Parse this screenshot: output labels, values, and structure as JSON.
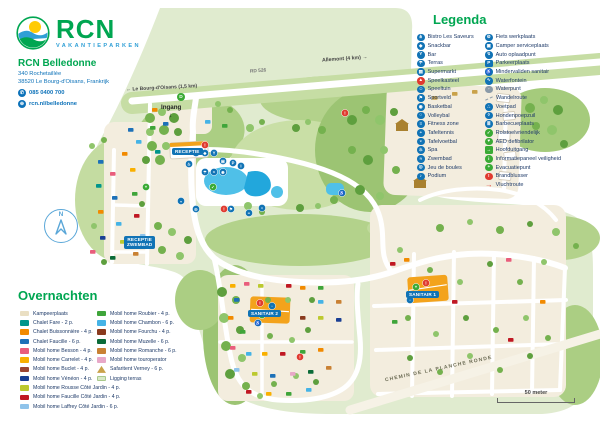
{
  "brand": {
    "logo": "RCN",
    "tagline": "VAKANTIEPARKEN"
  },
  "park": {
    "name": "RCN Belledonne",
    "address1": "340 Rochetaillée",
    "address2": "38520 Le Bourg-d'Oisans, Frankrijk",
    "phone": "085 0400 700",
    "website": "rcn.nl/belledonne"
  },
  "legend": {
    "title": "Legenda",
    "columns": [
      [
        {
          "label": "Bistro Les Saveurs",
          "icon": "restaurant-icon",
          "glyph": "⋔",
          "color": "#1173b5"
        },
        {
          "label": "Snackbar",
          "icon": "snackbar-icon",
          "glyph": "◆",
          "color": "#1173b5"
        },
        {
          "label": "Bar",
          "icon": "bar-icon",
          "glyph": "Y",
          "color": "#1173b5"
        },
        {
          "label": "Terras",
          "icon": "terrace-icon",
          "glyph": "☂",
          "color": "#1173b5"
        },
        {
          "label": "Supermarkt",
          "icon": "supermarket-icon",
          "glyph": "▤",
          "color": "#1173b5"
        },
        {
          "label": "Speelkasteel",
          "icon": "play-castle-icon",
          "glyph": "▲",
          "color": "#e03a2f"
        },
        {
          "label": "Speeltuin",
          "icon": "playground-icon",
          "glyph": "☺",
          "color": "#1173b5"
        },
        {
          "label": "Sportveld",
          "icon": "sports-field-icon",
          "glyph": "⚑",
          "color": "#1173b5"
        },
        {
          "label": "Basketbal",
          "icon": "basketball-icon",
          "glyph": "◉",
          "color": "#1173b5"
        },
        {
          "label": "Volleybal",
          "icon": "volleyball-icon",
          "glyph": "○",
          "color": "#1173b5"
        },
        {
          "label": "Fitness zone",
          "icon": "fitness-icon",
          "glyph": "≡",
          "color": "#1173b5"
        },
        {
          "label": "Tafeltennis",
          "icon": "table-tennis-icon",
          "glyph": "◓",
          "color": "#1173b5"
        },
        {
          "label": "Tafelvoetbal",
          "icon": "table-football-icon",
          "glyph": "◒",
          "color": "#1173b5"
        },
        {
          "label": "Spa",
          "icon": "spa-icon",
          "glyph": "♨",
          "color": "#1173b5"
        },
        {
          "label": "Zwembad",
          "icon": "swimming-pool-icon",
          "glyph": "≈",
          "color": "#1173b5"
        },
        {
          "label": "Jeu de boules",
          "icon": "petanque-icon",
          "glyph": "◎",
          "color": "#1173b5"
        },
        {
          "label": "Podium",
          "icon": "stage-icon",
          "glyph": "♪",
          "color": "#1173b5"
        }
      ],
      [
        {
          "label": "Fiets werkplaats",
          "icon": "bike-repair-icon",
          "glyph": "⚙",
          "color": "#1173b5"
        },
        {
          "label": "Camper serviceplaats",
          "icon": "camper-service-icon",
          "glyph": "▣",
          "color": "#1173b5"
        },
        {
          "label": "Auto oplaadpunt",
          "icon": "ev-charging-icon",
          "glyph": "↯",
          "color": "#1173b5"
        },
        {
          "label": "Parkeerplaats",
          "icon": "parking-icon",
          "glyph": "P",
          "color": "#1173b5",
          "shape": "square"
        },
        {
          "label": "Mindervaliden sanitair",
          "icon": "accessible-sanitary-icon",
          "glyph": "♿",
          "color": "#1173b5"
        },
        {
          "label": "Waterfontein",
          "icon": "water-fountain-icon",
          "glyph": "∿",
          "color": "#1173b5"
        },
        {
          "label": "Waterpunt",
          "icon": "water-point-icon",
          "glyph": "◦",
          "color": "#8a9aa8"
        },
        {
          "label": "Wandelroute",
          "icon": "walking-route-icon",
          "glyph": "",
          "color": "#8a9aa8",
          "shape": "dash"
        },
        {
          "label": "Voetpad",
          "icon": "footpath-icon",
          "glyph": "∴",
          "color": "#1173b5"
        },
        {
          "label": "Hondenpoepzuil",
          "icon": "dog-waste-icon",
          "glyph": "◊",
          "color": "#1173b5"
        },
        {
          "label": "Barbecueplaats",
          "icon": "barbecue-icon",
          "glyph": "≣",
          "color": "#1173b5"
        },
        {
          "label": "Rolstoelvriendelijk",
          "icon": "wheelchair-friendly-icon",
          "glyph": "✓",
          "color": "#3aaa35"
        },
        {
          "label": "AED defibrilator",
          "icon": "aed-icon",
          "glyph": "♥",
          "color": "#3aaa35"
        },
        {
          "label": "Hoofduitgang",
          "icon": "main-exit-icon",
          "glyph": "→",
          "color": "#3aaa35",
          "shape": "square"
        },
        {
          "label": "Informatiepaneel veiligheid",
          "icon": "safety-info-icon",
          "glyph": "i",
          "color": "#3aaa35"
        },
        {
          "label": "Evacuatiepunt",
          "icon": "evacuation-point-icon",
          "glyph": "+",
          "color": "#3aaa35"
        },
        {
          "label": "Brandblusser",
          "icon": "fire-extinguisher-icon",
          "glyph": "!",
          "color": "#e03a2f"
        },
        {
          "label": "Vluchtroute",
          "icon": "escape-route-icon",
          "glyph": "→",
          "color": "#e03a2f",
          "shape": "arrow"
        }
      ]
    ]
  },
  "stay": {
    "title": "Overnachten",
    "columns": [
      [
        {
          "label": "Kampeerplaats",
          "color": "#eadfc3"
        },
        {
          "label": "Chalet Fare - 2 p.",
          "color": "#00958c"
        },
        {
          "label": "Chalet Buissonnière - 4 p.",
          "color": "#f18a00"
        },
        {
          "label": "Chalet Faucille - 6 p.",
          "color": "#1d71b8"
        },
        {
          "label": "Mobil home Besson - 4 p.",
          "color": "#e95d7c"
        },
        {
          "label": "Mobil home Carrelet - 4 p.",
          "color": "#f9b000"
        },
        {
          "label": "Mobil home Buclet - 4 p.",
          "color": "#9c4532",
          "style": "stripes"
        },
        {
          "label": "Mobil home Vénéon - 4 p.",
          "color": "#1a3f94"
        },
        {
          "label": "Mobil home Rousse Côté Jardin - 4 p.",
          "color": "#bcc92f"
        },
        {
          "label": "Mobil home Faucille Côté Jardin - 4 p.",
          "color": "#c01823"
        },
        {
          "label": "Mobil home Laffrey Côté Jardin - 6 p.",
          "color": "#8fc3ea",
          "style": "stripes"
        }
      ],
      [
        {
          "label": "Mobil home Roubier - 4 p.",
          "color": "#3fa53a"
        },
        {
          "label": "Mobil home Chambon - 6 p.",
          "color": "#45b3e6"
        },
        {
          "label": "Mobil home Fourchu - 4 p.",
          "color": "#8a3a1e",
          "style": "stripes"
        },
        {
          "label": "Mobil home Muzelle - 6 p.",
          "color": "#0b6b38"
        },
        {
          "label": "Mobil home Romanche - 6 p.",
          "color": "#c98133",
          "style": "stripes"
        },
        {
          "label": "Mobil home touroperator",
          "color": "#e8a8c8",
          "style": "stripes"
        },
        {
          "label": "Safaritent Verney - 6 p.",
          "color": "#c9a24a",
          "style": "tent"
        },
        {
          "label": "Ligging terras",
          "color": "#d8e8c6",
          "style": "light"
        }
      ]
    ]
  },
  "map": {
    "labels": {
      "rd526": "RD 526",
      "allemont": "Allemont (4 km) →",
      "bourg": "← Le Bourg-d'Oisans (1,5 km)",
      "ingang": "Ingang",
      "ingang_arrow": "↓",
      "d_marker": "D",
      "receptie": "RECEPTIE",
      "receptie_zwembad_1": "RECEPTIE",
      "receptie_zwembad_2": "ZWEMBAD",
      "sanitair1": "SANITAIR 1",
      "sanitair2": "SANITAIR 2",
      "chemin": "CHEMIN DE LA PLANCHE RONDE",
      "scale": "50 meter",
      "compass_n": "N"
    }
  },
  "colors": {
    "brand_green": "#00a651",
    "brand_blue": "#2f9fd6",
    "legend_text": "#1e3a68",
    "poi_blue": "#1173b5",
    "map_green": "#e0ebcf",
    "woods_green": "#abce83",
    "pitch_cream": "#f3edde",
    "pool_blue": "#4fc0e8",
    "sanitair_orange": "#f3a31c"
  }
}
